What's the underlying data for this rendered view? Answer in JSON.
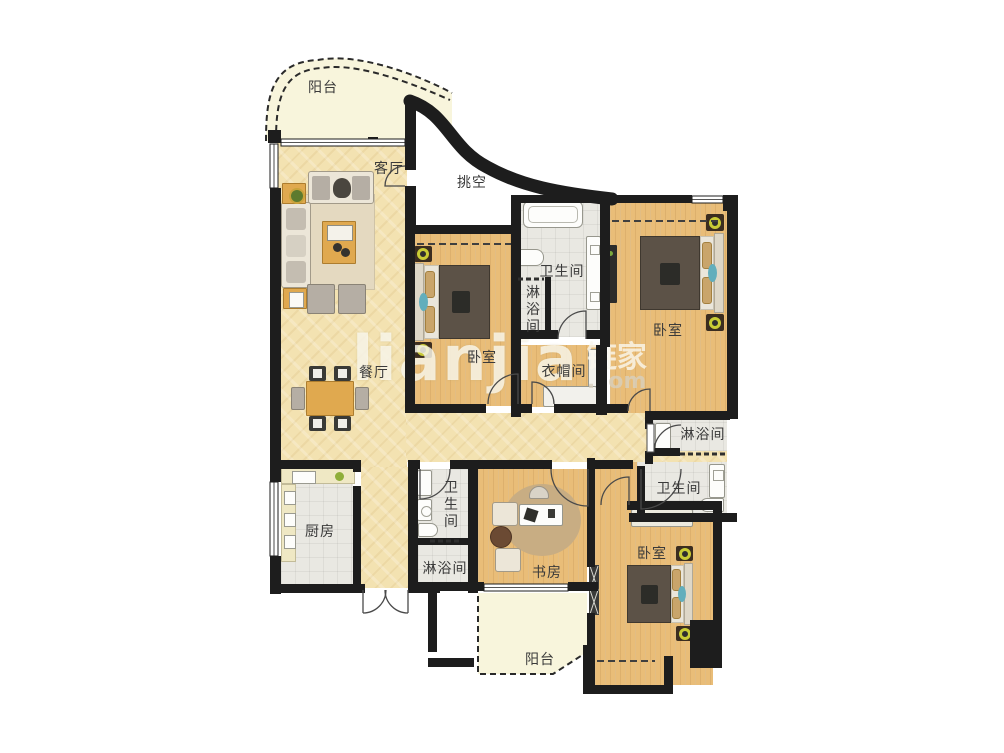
{
  "plan": {
    "title": "apartment-floor-plan",
    "watermark": {
      "brand": "lianjia",
      "cjk": "链家",
      "tld": ".com"
    },
    "palette": {
      "wall": "#1d1d1d",
      "wood_floor": "#e9bd78",
      "tile_floor": "#e9e8e2",
      "marble_floor": "#f3e2b1",
      "balcony_floor": "#f8f5dc",
      "accent_teal": "#62aebc",
      "lamp_yellow": "#c9cc35",
      "table_wood": "#e0a94f"
    },
    "rooms": [
      {
        "id": "balcony-top",
        "label": "阳台"
      },
      {
        "id": "living-room",
        "label": "客厅"
      },
      {
        "id": "void",
        "label": "挑空"
      },
      {
        "id": "bathroom-top",
        "label": "卫生间"
      },
      {
        "id": "shower-top",
        "label": "淋浴间"
      },
      {
        "id": "bedroom-top-right",
        "label": "卧室"
      },
      {
        "id": "bedroom-left",
        "label": "卧室"
      },
      {
        "id": "cloakroom",
        "label": "衣帽间"
      },
      {
        "id": "dining-room",
        "label": "餐厅"
      },
      {
        "id": "shower-right",
        "label": "淋浴间"
      },
      {
        "id": "bathroom-right",
        "label": "卫生间"
      },
      {
        "id": "kitchen",
        "label": "厨房"
      },
      {
        "id": "bathroom-small",
        "label": "卫生间"
      },
      {
        "id": "shower-small",
        "label": "淋浴间"
      },
      {
        "id": "study",
        "label": "书房"
      },
      {
        "id": "bedroom-bottom",
        "label": "卧室"
      },
      {
        "id": "balcony-bottom",
        "label": "阳台"
      }
    ]
  }
}
